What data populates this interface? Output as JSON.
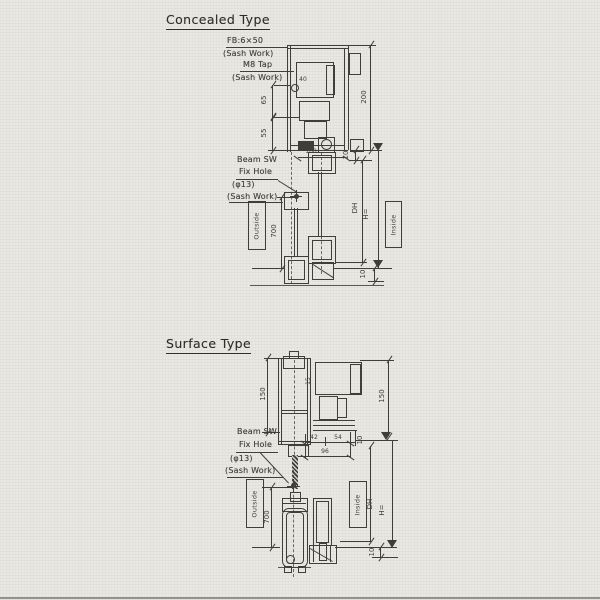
{
  "colors": {
    "paper": "#e9e8e3",
    "ink": "#3f3e3a"
  },
  "concealed": {
    "title": "Concealed Type",
    "fb_label": "FB:6×50",
    "fb_sub": "(Sash Work)",
    "m8_label": "M8 Tap",
    "m8_sub": "(Sash Work)",
    "beam_sw": "Beam SW",
    "fix_hole": "Fix Hole",
    "phi": "(φ13)",
    "sash": "(Sash Work)",
    "outside": "Outside",
    "inside": "Inside",
    "dims": {
      "header_height": "200",
      "fb_offset": "65",
      "tap_offset": "55",
      "unit_width": "40",
      "track_width": "100",
      "hole_to_floor": "700",
      "top_offset": "10",
      "floor_offset": "10",
      "door_height": "DH",
      "height_note": "H="
    }
  },
  "surface": {
    "title": "Surface Type",
    "beam_sw": "Beam SW",
    "fix_hole": "Fix Hole",
    "phi": "(φ13)",
    "sash": "(Sash Work)",
    "outside": "Outside",
    "inside": "Inside",
    "dims": {
      "unit_height_left": "150",
      "unit_height_right": "150",
      "unit_offset": "15",
      "hole_to_screen": "42",
      "screen_to_face": "54",
      "hole_to_face": "96",
      "face_gap": "10",
      "hole_to_floor": "700",
      "floor_offset": "10",
      "door_height": "DH",
      "height_note": "H="
    }
  }
}
